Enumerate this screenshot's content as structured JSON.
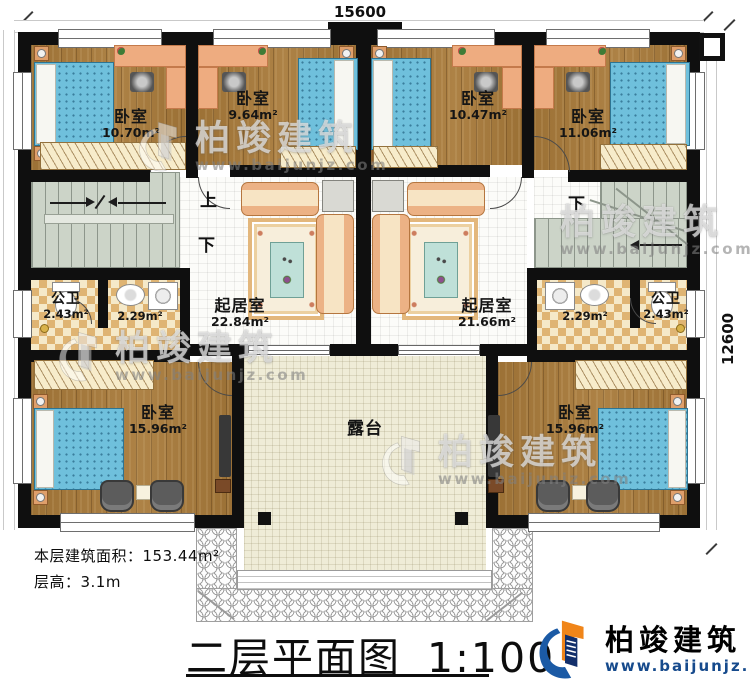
{
  "dimensions": {
    "width_label": "15600",
    "height_label": "12600"
  },
  "title": {
    "text": "二层平面图",
    "scale": "1:100"
  },
  "notes": {
    "floor_area": "本层建筑面积：153.44m²",
    "floor_height": "层高：3.1m"
  },
  "brand": {
    "name": "柏竣建筑",
    "url": "www.baijunjz.com"
  },
  "watermark": {
    "name": "柏竣建筑",
    "url": "www.baijunjz.com"
  },
  "stairs": {
    "up": "上",
    "down": "下"
  },
  "rooms": {
    "bedroom_top_left": {
      "name": "卧室",
      "area": "10.70m²"
    },
    "bedroom_top_mid_left": {
      "name": "卧室",
      "area": "9.64m²"
    },
    "bedroom_top_mid_right": {
      "name": "卧室",
      "area": "10.47m²"
    },
    "bedroom_top_right": {
      "name": "卧室",
      "area": "11.06m²"
    },
    "living_left": {
      "name": "起居室",
      "area": "22.84m²"
    },
    "living_right": {
      "name": "起居室",
      "area": "21.66m²"
    },
    "bath_left": {
      "name": "公卫",
      "area": "2.43m²"
    },
    "wash_left": {
      "area": "2.29m²"
    },
    "wash_right": {
      "area": "2.29m²"
    },
    "bath_right": {
      "name": "公卫",
      "area": "2.43m²"
    },
    "bedroom_bottom_left": {
      "name": "卧室",
      "area": "15.96m²"
    },
    "bedroom_bottom_right": {
      "name": "卧室",
      "area": "15.96m²"
    },
    "terrace": {
      "name": "露台"
    }
  },
  "colors": {
    "wall": "#111111",
    "wood": "#a87a3a",
    "brand_blue": "#1b5aa5",
    "brand_orange": "#f08519",
    "bed_blue": "#6fc0dc"
  }
}
